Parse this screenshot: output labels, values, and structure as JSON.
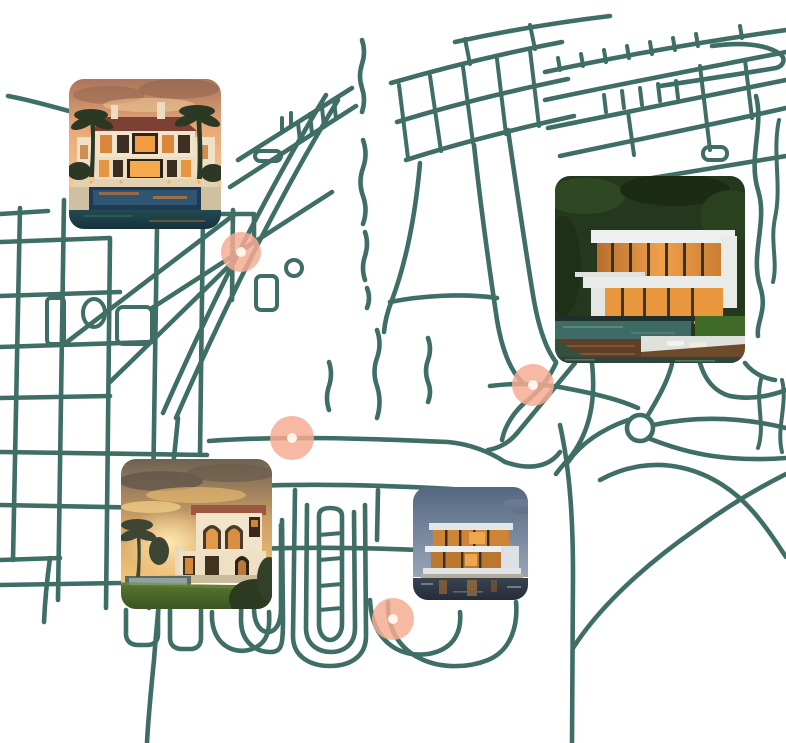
{
  "app": {
    "name": "luxury-property-map"
  },
  "theme": {
    "background": "#ffffff",
    "road_color": "#3E6E66",
    "marker_fill": "rgba(246,172,148,0.85)",
    "marker_dot": "#FFF4EA"
  },
  "map": {
    "markers": [
      {
        "id": "marker-northwest",
        "x": 241,
        "y": 252,
        "diameter": 40
      },
      {
        "id": "marker-west",
        "x": 292,
        "y": 438,
        "diameter": 44
      },
      {
        "id": "marker-east",
        "x": 533,
        "y": 385,
        "diameter": 42
      },
      {
        "id": "marker-south",
        "x": 393,
        "y": 619,
        "diameter": 42
      }
    ],
    "properties": [
      {
        "id": "photo-1",
        "label": "mediterranean-estate-at-sunset-with-pool",
        "x": 69,
        "y": 79,
        "width": 152,
        "height": 150
      },
      {
        "id": "photo-2",
        "label": "modern-waterfront-glass-villa-at-sunset",
        "x": 555,
        "y": 176,
        "width": 190,
        "height": 187
      },
      {
        "id": "photo-3",
        "label": "spanish-style-villa-at-golden-sunset",
        "x": 121,
        "y": 459,
        "width": 151,
        "height": 150
      },
      {
        "id": "photo-4",
        "label": "contemporary-villa-at-dusk-over-water",
        "x": 413,
        "y": 487,
        "width": 115,
        "height": 113
      }
    ]
  }
}
